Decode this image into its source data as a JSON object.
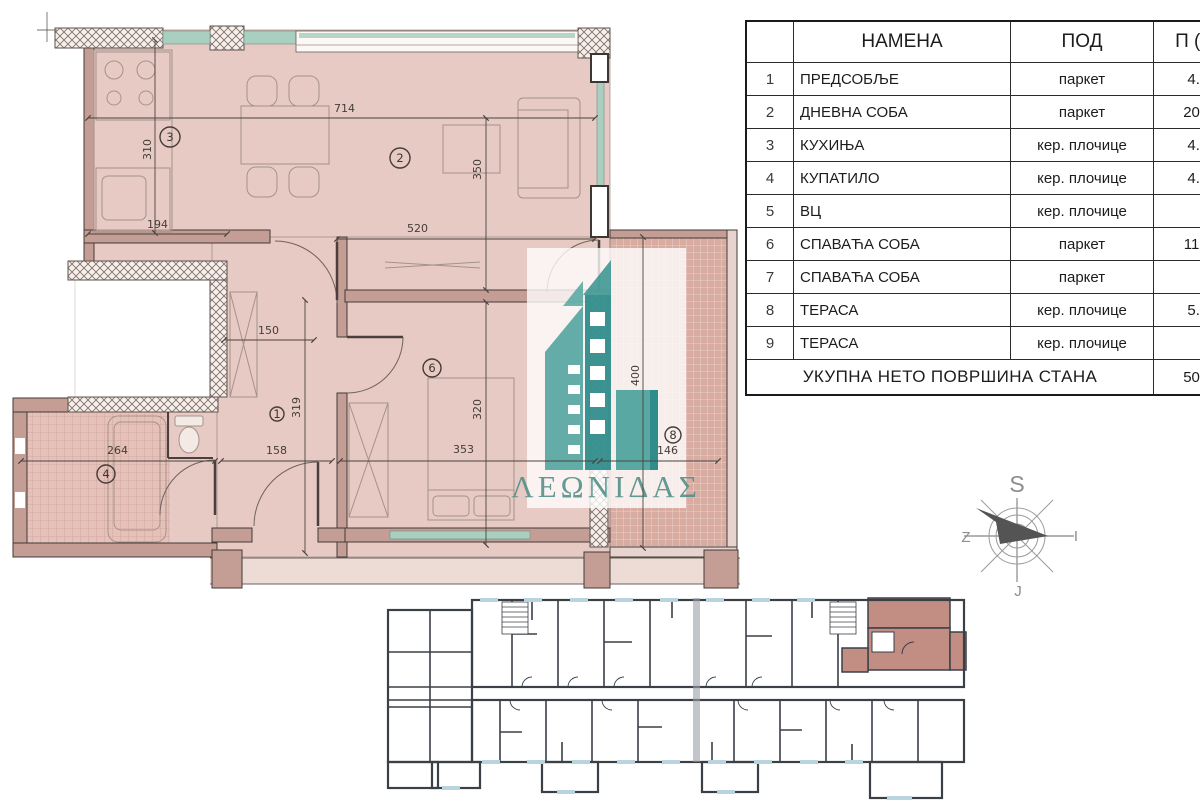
{
  "table": {
    "col_headers": {
      "name": "НАМЕНА",
      "floor": "ПОД",
      "area": "П (m²)"
    },
    "rows": [
      {
        "num": "1",
        "name": "ПРЕДСОБЉЕ",
        "floor": "паркет",
        "area": "4.80"
      },
      {
        "num": "2",
        "name": "ДНЕВНА СОБА",
        "floor": "паркет",
        "area": "20.10"
      },
      {
        "num": "3",
        "name": "КУХИЊА",
        "floor": "кер. плочице",
        "area": "4.00"
      },
      {
        "num": "4",
        "name": "КУПАТИЛО",
        "floor": "кер. плочице",
        "area": "4.20"
      },
      {
        "num": "5",
        "name": "ВЦ",
        "floor": "кер. плочице",
        "area": "/"
      },
      {
        "num": "6",
        "name": "СПАВАЋА СОБА",
        "floor": "паркет",
        "area": "11.40"
      },
      {
        "num": "7",
        "name": "СПАВАЋА СОБА",
        "floor": "паркет",
        "area": "/"
      },
      {
        "num": "8",
        "name": "ТЕРАСА",
        "floor": "кер. плочице",
        "area": "5.50"
      },
      {
        "num": "9",
        "name": "ТЕРАСА",
        "floor": "кер. плочице",
        "area": "/"
      }
    ],
    "total_label": "УКУПНА НЕТО ПОВРШИНА СТАНА",
    "total_value": "50.00"
  },
  "logo": {
    "text": "ΛΕΩΝΙΔΑΣ",
    "accent_color": "#2f8e8c"
  },
  "compass": {
    "n": "S",
    "e": "I",
    "s": "J",
    "w": "Z"
  },
  "plan": {
    "dims": {
      "top_width": "714",
      "kitchen_height": "310",
      "kitchen_width": "194",
      "living_width": "520",
      "living_height": "350",
      "hall_width": "150",
      "hall_height": "319",
      "entry_width": "158",
      "bedroom_width": "353",
      "bedroom_height": "320",
      "bath_width": "264",
      "terrace_height": "400",
      "terrace_width": "146"
    },
    "rooms": {
      "hall": "1",
      "living": "2",
      "kitchen": "3",
      "bath": "4",
      "bedroom": "6",
      "terrace": "8"
    }
  }
}
